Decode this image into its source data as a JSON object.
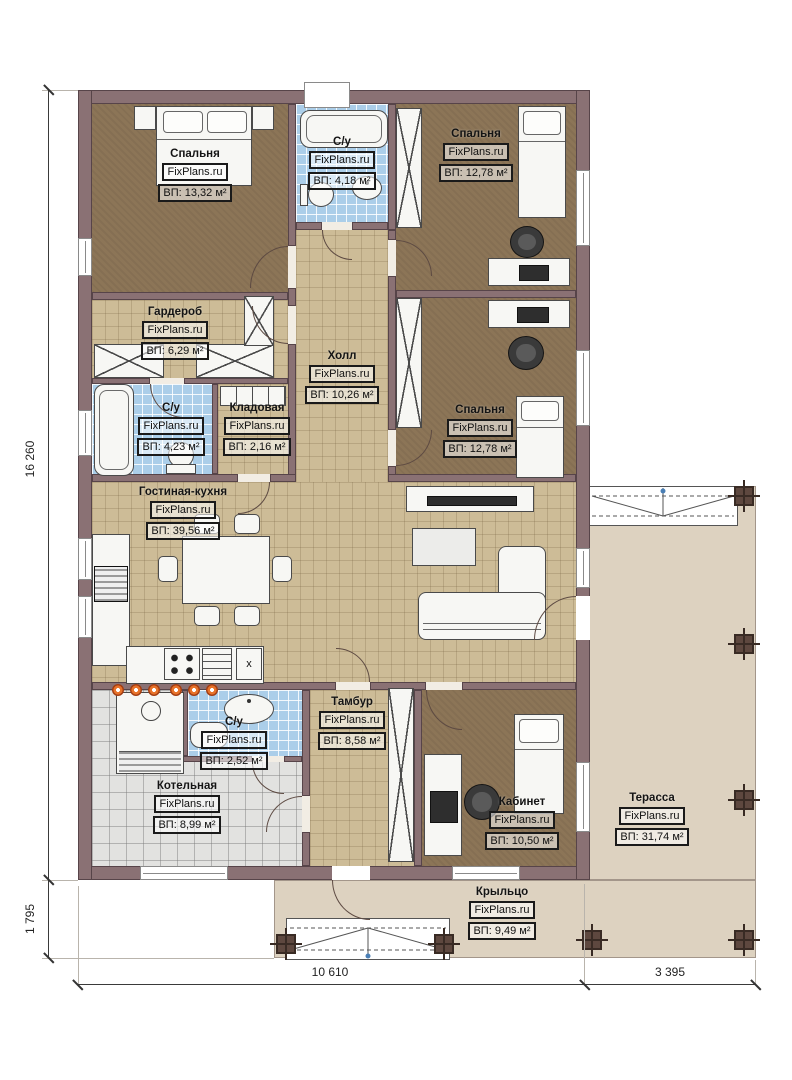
{
  "brand": "FixPlans.ru",
  "rooms": [
    {
      "name": "Спальня",
      "area": "ВП: 13,32 м²"
    },
    {
      "name": "С/у",
      "area": "ВП: 4,18 м²"
    },
    {
      "name": "Спальня",
      "area": "ВП: 12,78 м²"
    },
    {
      "name": "Гардероб",
      "area": "ВП: 6,29 м²"
    },
    {
      "name": "С/у",
      "area": "ВП: 4,23 м²"
    },
    {
      "name": "Кладовая",
      "area": "ВП: 2,16 м²"
    },
    {
      "name": "Холл",
      "area": "ВП: 10,26 м²"
    },
    {
      "name": "Спальня",
      "area": "ВП: 12,78 м²"
    },
    {
      "name": "Гостиная-кухня",
      "area": "ВП: 39,56 м²"
    },
    {
      "name": "Котельная",
      "area": "ВП: 8,99 м²"
    },
    {
      "name": "С/у",
      "area": "ВП: 2,52 м²"
    },
    {
      "name": "Тамбур",
      "area": "ВП: 8,58 м²"
    },
    {
      "name": "Кабинет",
      "area": "ВП: 10,50 м²"
    },
    {
      "name": "Терасса",
      "area": "ВП: 31,74 м²"
    },
    {
      "name": "Крыльцо",
      "area": "ВП: 9,49 м²"
    }
  ],
  "dimensions": {
    "left_total": "16 260",
    "left_porch": "1 795",
    "bottom_main": "10 610",
    "bottom_right": "3 395"
  },
  "kitchen_cabinet_mark": "x",
  "colors": {
    "wall": "#8a7174",
    "bedroom_floor": "#8c7557",
    "tile_tan": "#cdbc97",
    "tile_blue": "#abcee9",
    "tile_gray": "#e2e2e0",
    "deck": "#ddd2c0",
    "heating_dot": "#e8732a"
  }
}
